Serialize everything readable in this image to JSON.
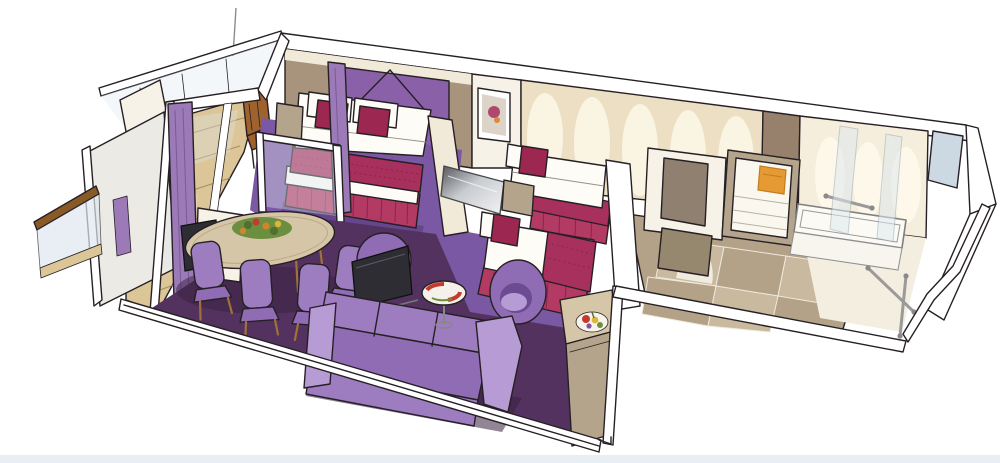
{
  "meta": {
    "type": "illustration",
    "subject": "cruise-ship suite cutaway floor plan",
    "style": "hand-drawn watercolor marker rendering",
    "view": "isometric cutaway, no visible text"
  },
  "palette": {
    "paper": "#ffffff",
    "ink": "#262025",
    "wall_white": "#f6f2e8",
    "wall_cream": "#f1ead9",
    "wall_taupe": "#a8937d",
    "wall_taupe_dark": "#97816c",
    "arch_bg": "#ecdfc4",
    "arch": "#faf4e3",
    "arch_bg2": "#f5eedd",
    "arch2": "#fdf8ea",
    "carpet_living": "#54325f",
    "carpet_shadow": "#37203f",
    "carpet_bedroom": "#7b58a3",
    "carpet_bedroom_shadow": "#5d3f85",
    "upholstery": "#9d7cc0",
    "upholstery_mid": "#8f6cb4",
    "upholstery_dark": "#6c4b92",
    "upholstery_light": "#b79bd4",
    "bed_white": "#fdfcf7",
    "bed_runner": "#a8305c",
    "bed_skirt": "#b23a63",
    "bed_pleat": "#8c2350",
    "cushion": "#9c2750",
    "headboard": "#8a61a8",
    "curtain": "#9c7ab8",
    "curtain_fold": "#7b5a97",
    "deck_wood": "#dcc597",
    "deck_line": "#a98d5f",
    "rail_wood": "#8a5a26",
    "chair_wood": "#a0622d",
    "leg_wood": "#a0713a",
    "tile_light": "#c9b99f",
    "tile_mid": "#b3a288",
    "tile_dark": "#96876f",
    "door_taupe": "#8f8070",
    "cabinet_taupe": "#b5a48c",
    "glass": "#dfe8ee",
    "glass_blue": "#ccd8e2",
    "tv_dark": "#2e2d33",
    "silver_hi": "#f2f3f4",
    "silver_lo": "#bfc3c6",
    "table_top": "#d6c6a8",
    "towel": "#e59a33",
    "plate_red": "#c23b2e",
    "leaf": "#6b8f3f",
    "fruit_yellow": "#e0b63a",
    "metal": "#9a9a9a",
    "footer": "#e9eef4"
  },
  "scene": {
    "rooms": [
      {
        "id": "balcony",
        "items": [
          "glass-balustrade",
          "privacy-partition-panels",
          "wood-plank-deck",
          "wooden-deck-chair",
          "flag-pole",
          "neighbour-balcony-rail"
        ]
      },
      {
        "id": "master-bedroom",
        "items": [
          "double-bed",
          "purple-headboard",
          "white-duvet",
          "crimson-runner",
          "pleated-bed-skirt",
          "accent-cushions-x2",
          "nightstand",
          "wall-picture",
          "balcony-curtains",
          "low-glass-divider",
          "purple-carpet"
        ]
      },
      {
        "id": "living-dining-room",
        "items": [
          "oval-dining-table",
          "flower-centerpiece",
          "dining-chairs-x4",
          "desk-tv-console",
          "barrel-armchair",
          "tv-on-stand",
          "purple-sofa",
          "tub-chair",
          "glass-side-table",
          "decorative-plate",
          "sideboard",
          "fruit-plate",
          "dark-plum-carpet"
        ]
      },
      {
        "id": "second-bedroom",
        "items": [
          "twin-beds-x2",
          "accent-cushions-x2",
          "shared-nightstand",
          "wall-mounted-tv",
          "arched-feature-wall",
          "purple-carpet"
        ]
      },
      {
        "id": "entry-corridor",
        "items": [
          "beige-tiled-floor",
          "wardrobe-doors",
          "open-shelf-cabinet",
          "orange-towel"
        ]
      },
      {
        "id": "bathroom",
        "items": [
          "bathtub",
          "grab-rails-x3",
          "glass-shower-screens-x2",
          "arched-wall",
          "corner-window-panel"
        ]
      }
    ],
    "counts": {
      "dining_chairs": 4,
      "twin_beds": 2,
      "grab_rails": 3,
      "arches_left_wall": 5,
      "arches_bath_wall": 3
    }
  }
}
